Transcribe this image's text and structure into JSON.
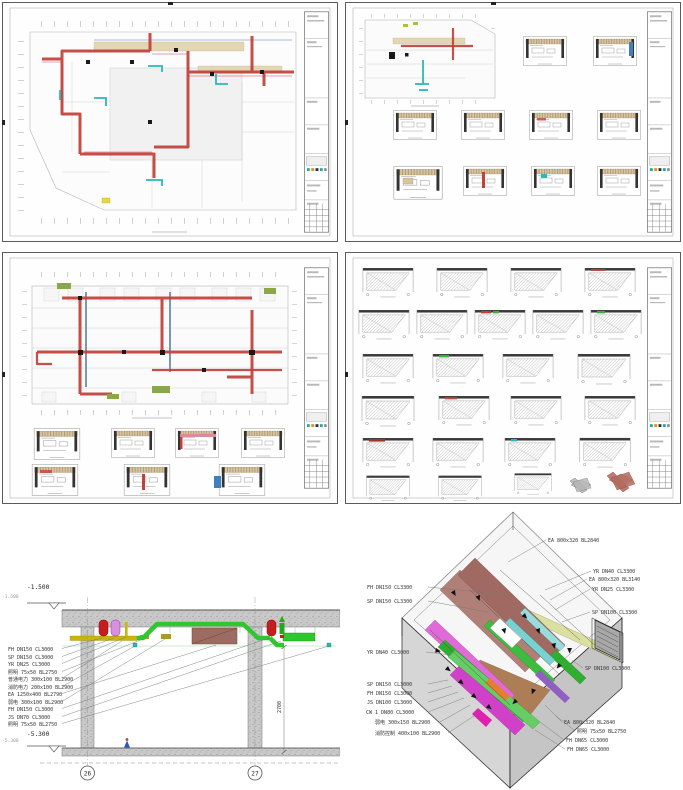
{
  "colors": {
    "duct_red": "#c2403a",
    "pipe_green": "#2ec72e",
    "tray_yellow": "#c9b50e",
    "duct_brown": "#9c6b62",
    "tank_red": "#c41e1e",
    "tank_magenta": "#d98fd9",
    "cyan_pipe": "#2ab8b8",
    "ceiling_beige": "#e3d6b2",
    "concrete_gray": "#c6c6c6"
  },
  "section": {
    "elev_top": "-1.500",
    "elev_top_small": "-1.500",
    "elev_bottom": "-5.300",
    "elev_bottom_small": "-5.300",
    "dim_height": "2700",
    "grid_bubbles": [
      "26",
      "27"
    ],
    "labels": [
      "FH DN150 CL3000",
      "SP DN150 CL3000",
      "YR DN25 CL3000",
      "照明 75x50 BL2750",
      "普通电力 300x100 BL2900",
      "消防电力 200x100 BL2900",
      "EA 1250x400 BL2790",
      "弱电 300x100 BL2900",
      "FH DN150 CL3000",
      "JS DN70 CL3000",
      "照明 75x50 BL2750"
    ]
  },
  "axon": {
    "left_labels": [
      "FH DN150 CL3300",
      "SP DN150 CL3300",
      "YR DN40 CL3000",
      "SP DN150 CL3000",
      "FH DN150 CL3000",
      "JS DN100 CL3000",
      "CW 1 DN80 CL3000",
      "弱电 300x150 BL2900",
      "消防控制 400x100 BL2900"
    ],
    "right_labels": [
      "EA 800x320 BL2840",
      "YR DN40 CL3300",
      "EA 800x320 BL3140",
      "YR DN25 CL3300",
      "SP DN100 CL3300",
      "SP DN100 CL3000",
      "EA 800x320 BL2840",
      "照明 75x50 BL2750",
      "FH DN65 CL3000",
      "FH DN65 CL3000"
    ]
  }
}
